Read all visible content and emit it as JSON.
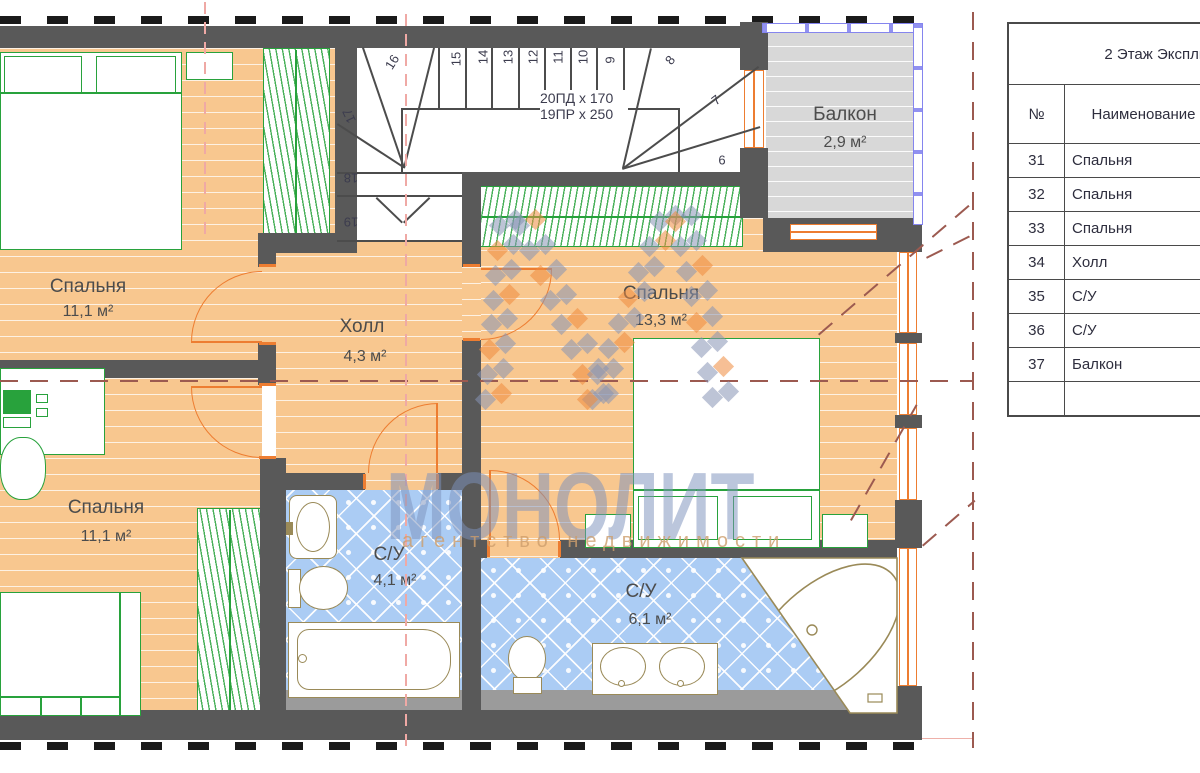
{
  "plan": {
    "rooms": [
      {
        "name": "Спальня",
        "area": "11,1 м²"
      },
      {
        "name": "Спальня",
        "area": "11,1 м²"
      },
      {
        "name": "Холл",
        "area": "4,3 м²"
      },
      {
        "name": "Спальня",
        "area": "13,3 м²"
      },
      {
        "name": "С/У",
        "area": "4,1 м²"
      },
      {
        "name": "С/У",
        "area": "6,1 м²"
      },
      {
        "name": "Балкон",
        "area": "2,9 м²"
      }
    ],
    "stair_notes": [
      "20ПД x 170",
      "19ПР x 250"
    ],
    "steps": [
      "6",
      "7",
      "8",
      "9",
      "10",
      "11",
      "12",
      "13",
      "14",
      "15",
      "16",
      "17",
      "18",
      "19"
    ]
  },
  "watermark": {
    "title": "МОНОЛИТ",
    "subtitle": "агентство недвижимости"
  },
  "table": {
    "title": "2 Этаж Экспликация",
    "headers": {
      "num": "№",
      "name": "Наименование"
    },
    "rows": [
      {
        "num": "31",
        "name": "Спальня"
      },
      {
        "num": "32",
        "name": "Спальня"
      },
      {
        "num": "33",
        "name": "Спальня"
      },
      {
        "num": "34",
        "name": "Холл"
      },
      {
        "num": "35",
        "name": "С/У"
      },
      {
        "num": "36",
        "name": "С/У"
      },
      {
        "num": "37",
        "name": "Балкон"
      },
      {
        "num": "",
        "name": ""
      }
    ]
  },
  "palette": {
    "wall": "#595959",
    "wood_floor": "#f8c78f",
    "tile_floor": "#abccf4",
    "balcony_floor": "#d8d8d8",
    "furniture_green": "#28a23c",
    "fixture_tan": "#9a8a58",
    "door_window_orange": "#ed7d31",
    "railing_blue": "#8585ee",
    "roof_dash": "#9c5a50",
    "axis_pink": "#efa9a5",
    "watermark_blue": "#7c92bc",
    "watermark_orange": "#ef8a3e"
  }
}
